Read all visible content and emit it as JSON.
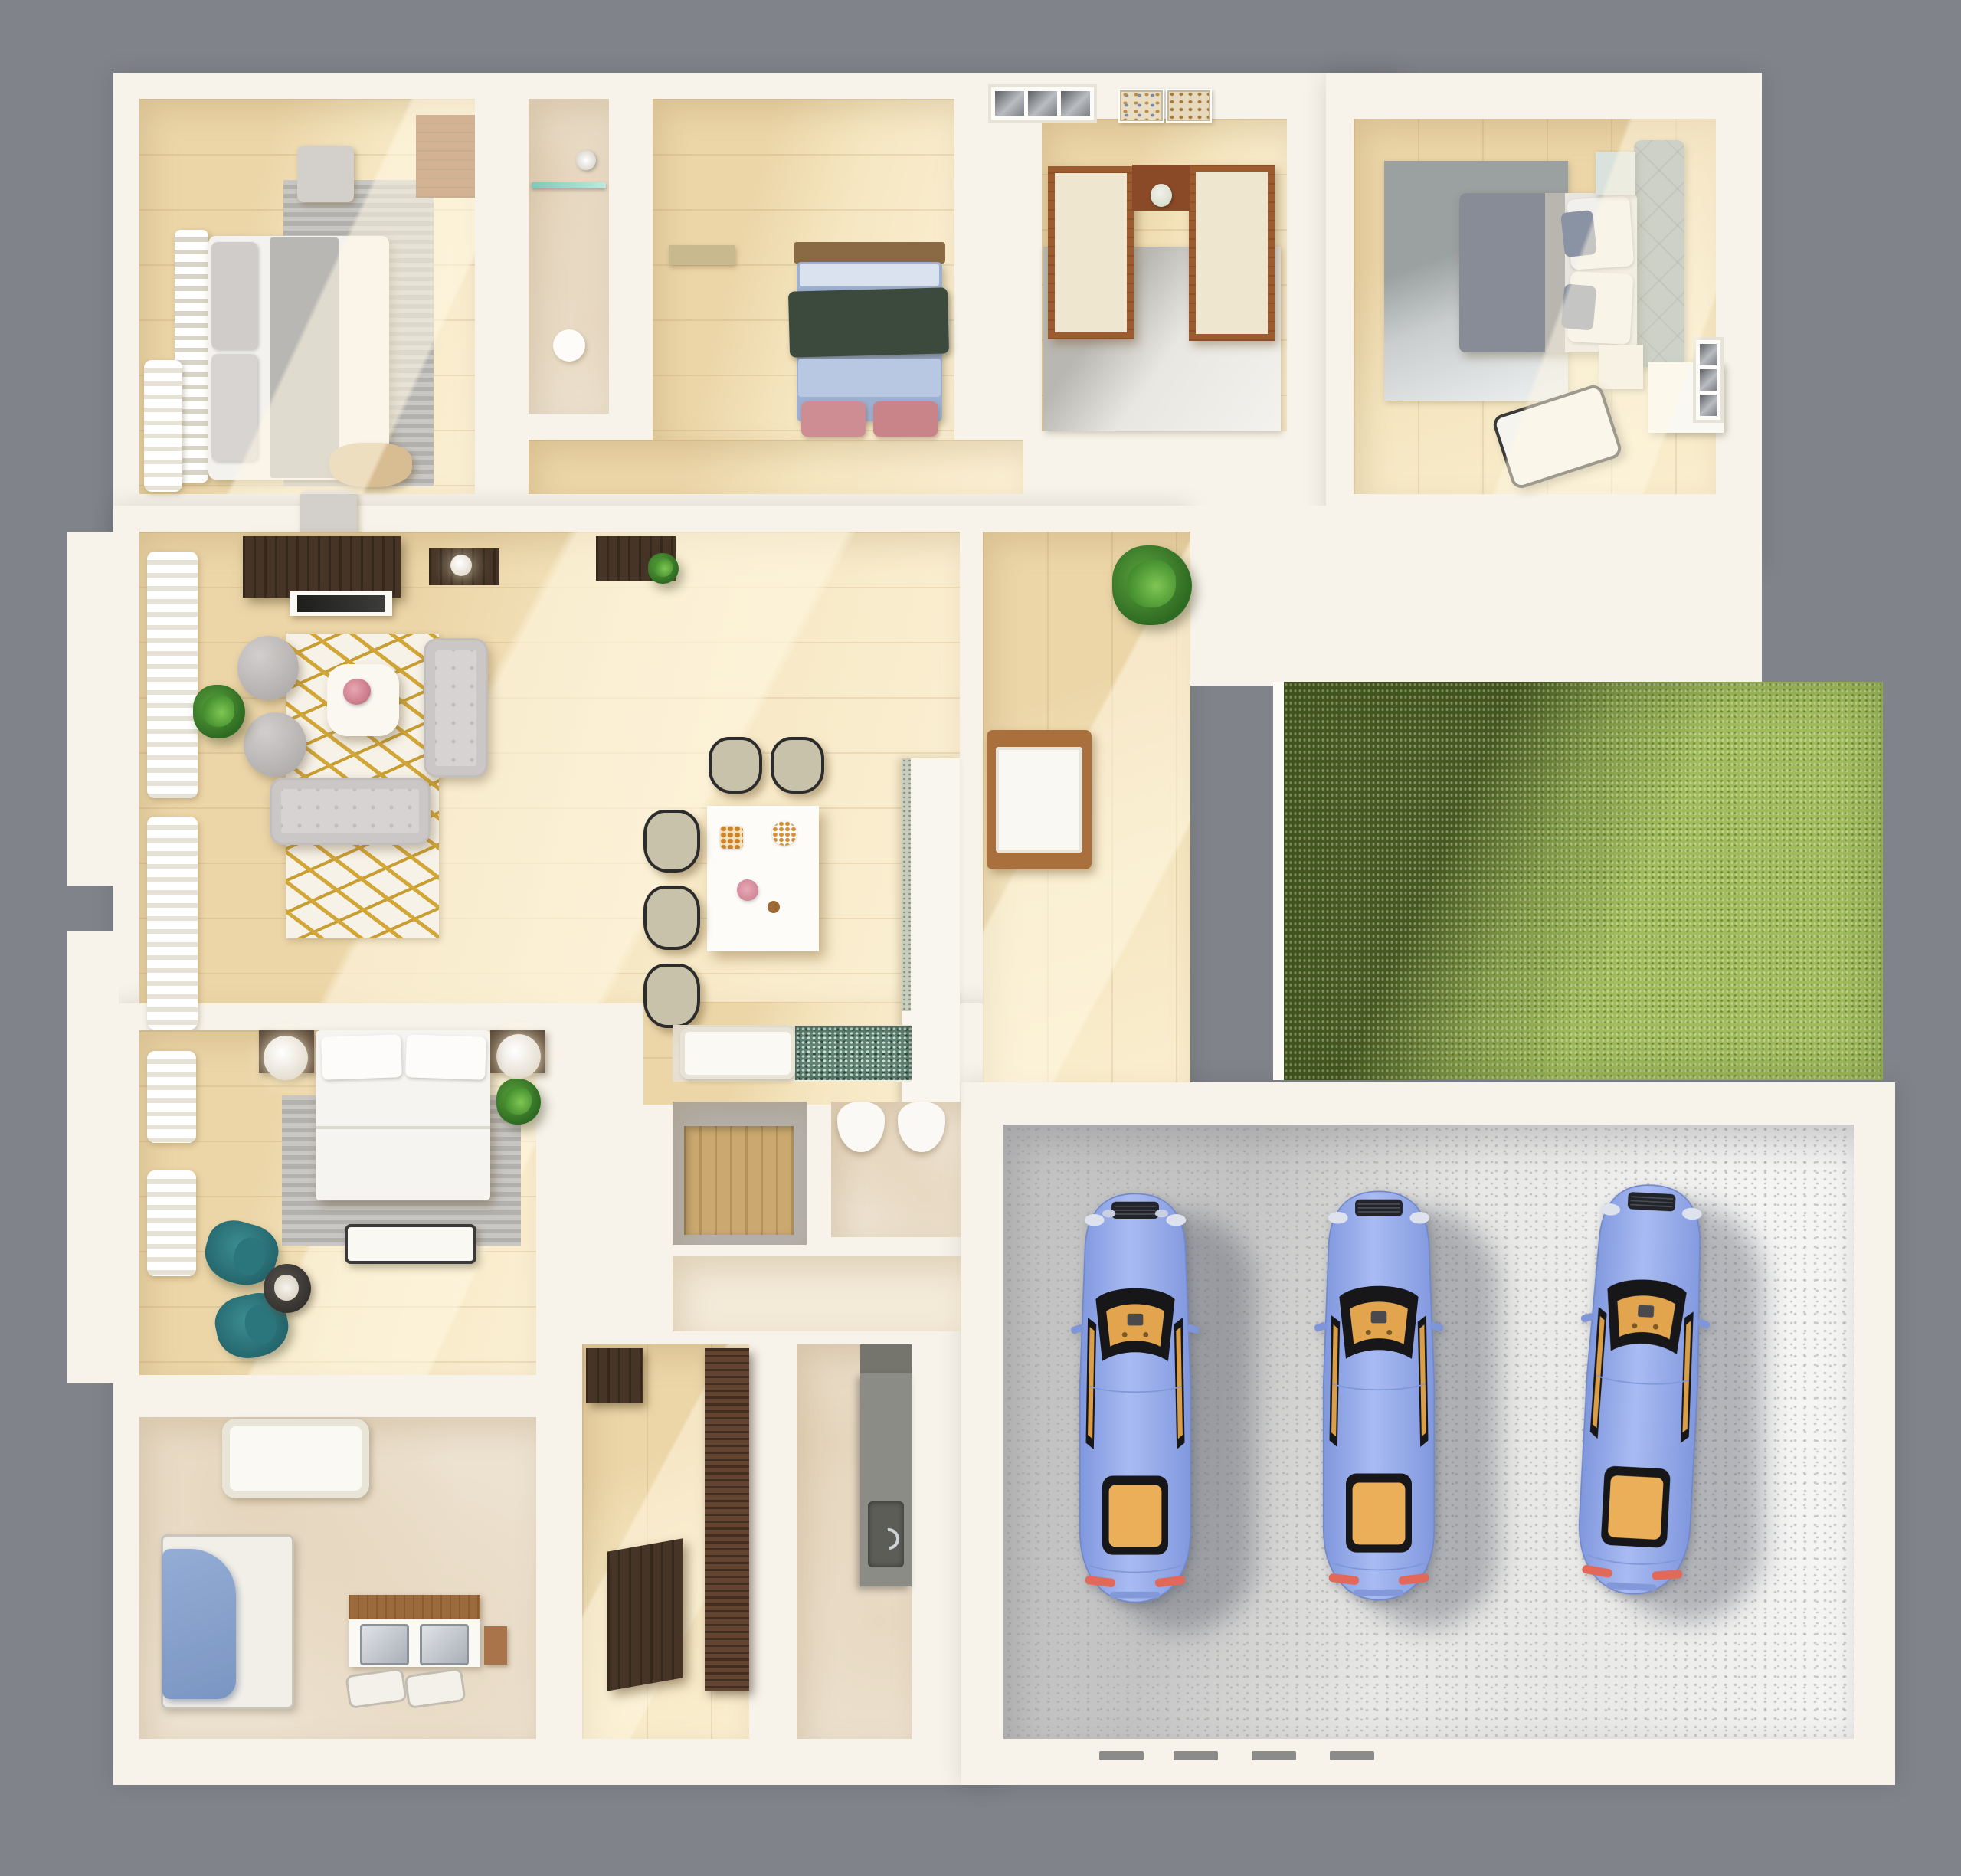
{
  "scene": {
    "type": "3d-floor-plan-render",
    "view": "top-down isometric",
    "background_color": "#80848a",
    "wall_color": "#f7f3ea",
    "wood_floor_color": "#f0ddb6",
    "marble_floor_color": "#ede2d0",
    "grass_color": "#a0bb5c",
    "grass_shadow_color": "#52682a",
    "garage_floor_color": "#e8e8e6",
    "gold_rug_accent": "#d2a637",
    "teal_accent": "#2b757c"
  },
  "rooms": [
    {
      "name": "Bedroom (top left)",
      "floor": "wood"
    },
    {
      "name": "Shower room",
      "floor": "marble"
    },
    {
      "name": "Kids bedroom",
      "floor": "wood"
    },
    {
      "name": "Bedroom-wing hallway",
      "floor": "wood"
    },
    {
      "name": "Study / office",
      "floor": "wood with rug"
    },
    {
      "name": "Bedroom (top right)",
      "floor": "wood"
    },
    {
      "name": "Living room",
      "floor": "wood"
    },
    {
      "name": "Dining area",
      "floor": "wood"
    },
    {
      "name": "Entry hall",
      "floor": "wood"
    },
    {
      "name": "Courtyard lawn",
      "floor": "grass"
    },
    {
      "name": "Garage",
      "floor": "concrete terrazzo"
    },
    {
      "name": "Bathtub nook",
      "floor": "tile"
    },
    {
      "name": "Closet",
      "floor": "concrete"
    },
    {
      "name": "Toilet room",
      "floor": "marble"
    },
    {
      "name": "Kitchen / pantry",
      "floor": "wood"
    },
    {
      "name": "Mudroom / utility",
      "floor": "marble"
    },
    {
      "name": "Master bedroom (bottom left)",
      "floor": "wood"
    },
    {
      "name": "Master bathroom",
      "floor": "marble"
    }
  ],
  "furniture": {
    "bedroom_top_left": [
      "slatted headboard bed",
      "gray pillows",
      "gray striped rug",
      "ottoman cubes",
      "tan bench",
      "wood wardrobe",
      "white curtains"
    ],
    "shower_room": [
      "glass shelf",
      "shower head",
      "marble floor"
    ],
    "kids_bedroom": [
      "single bed with blue sheets",
      "dark green blanket",
      "pink ottomans",
      "desk shelf"
    ],
    "study": [
      "U-shaped desk with cream tops",
      "three-pane window",
      "two art prints",
      "gray rug",
      "flower vase"
    ],
    "bedroom_top_right": [
      "double bed with gray duvet",
      "tufted teal headboard",
      "white pillows",
      "two nightstands",
      "gray rug",
      "white lounge chair",
      "white dresser",
      "window"
    ],
    "living_room": [
      "dark wood media console",
      "TV panel",
      "floating shelves",
      "round lamp",
      "two tufted poufs",
      "two tufted sofas",
      "white-gold rug",
      "white coffee table with flowers",
      "potted plant",
      "white curtains"
    ],
    "dining_area": [
      "white dining table",
      "five black-frame chairs with beige cushions",
      "table setting",
      "kitchen counter"
    ],
    "entry_hall": [
      "potted palm",
      "wood bench with white cushion"
    ],
    "garage": [
      "three blue sports cars",
      "floor vents"
    ],
    "bathtub_nook": [
      "white tub deck",
      "teal mosaic water"
    ],
    "toilet_room": [
      "two white toilets"
    ],
    "kitchen": [
      "dark wood upper cabinet",
      "dark wood island",
      "tall dark wood cabinet"
    ],
    "mudroom": [
      "gray counter with sink",
      "faucet"
    ],
    "master_bedroom": [
      "white double bed",
      "two dark nightstands",
      "two glowing sphere lamps",
      "gray striped rug",
      "bench",
      "two teal armchairs",
      "round side table with flowers",
      "white curtains",
      "plant"
    ],
    "master_bathroom": [
      "white bathtub",
      "glass shower with blue panel",
      "double-sink wood vanity",
      "two bath mats",
      "side cabinet"
    ]
  },
  "vehicles": {
    "count": 3,
    "type": "sports car, top view",
    "body_color": "#8fa7e9",
    "glass_color": "#1a1a1e",
    "interior_color": "#e7a94f",
    "tail_light_color": "#e2685a"
  }
}
